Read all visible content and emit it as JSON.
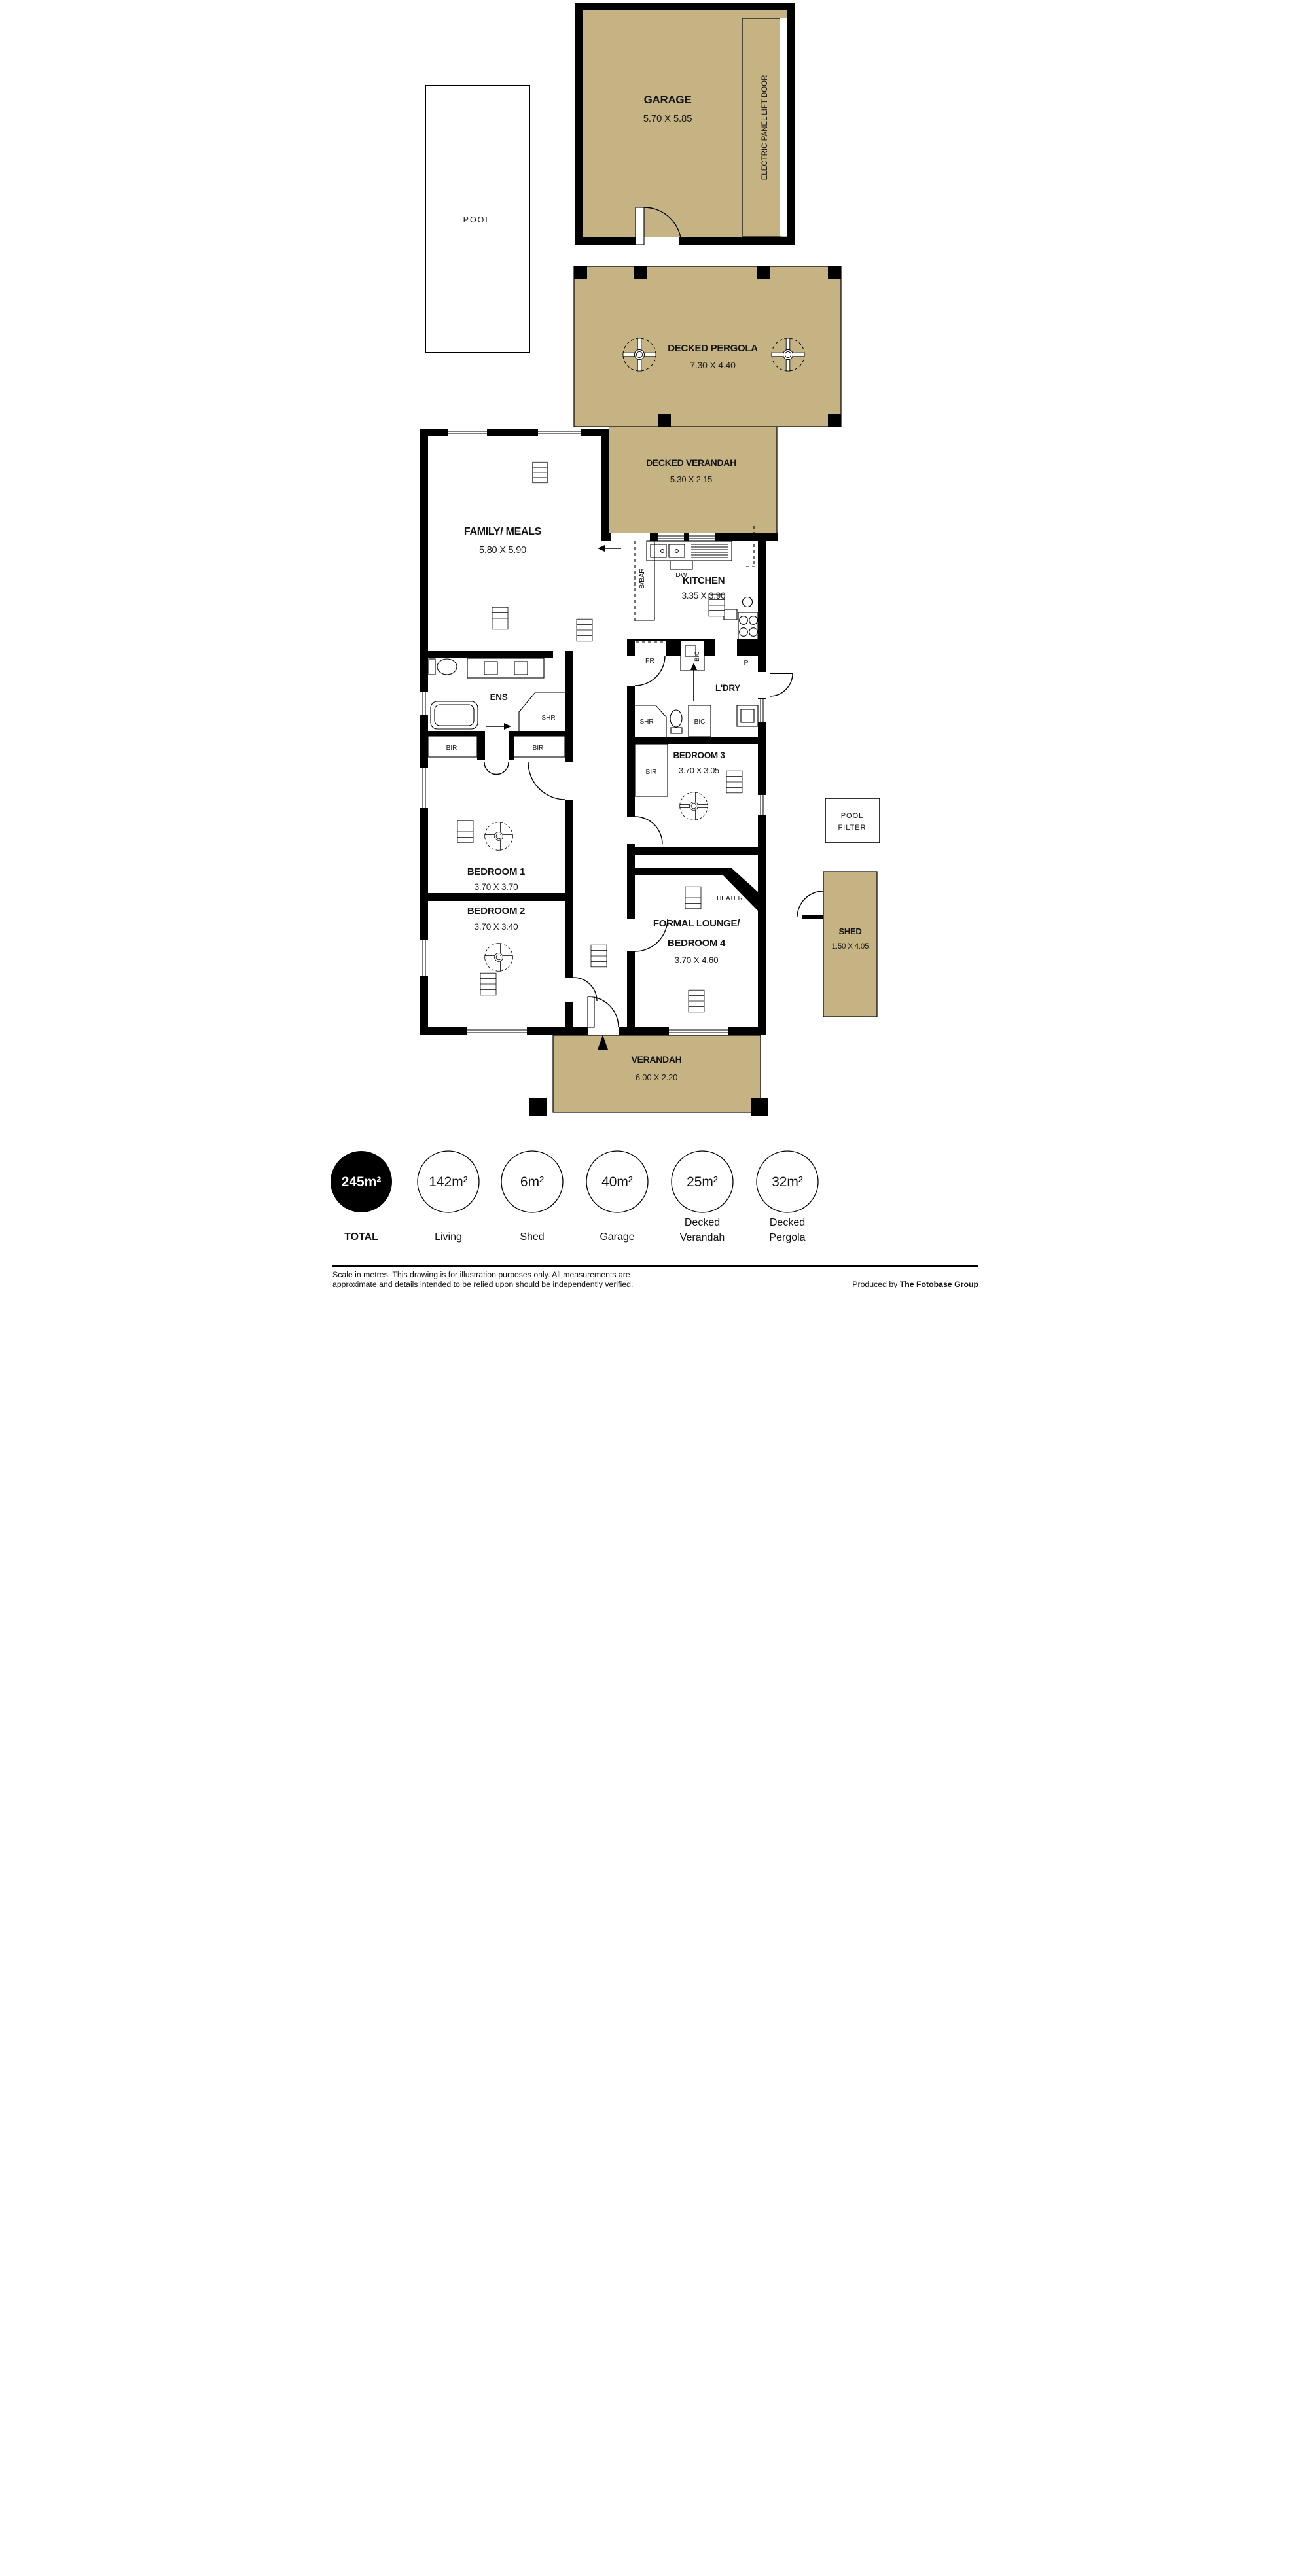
{
  "colors": {
    "deck": "#c6b383",
    "wall": "#000000",
    "paper": "#ffffff"
  },
  "garage": {
    "name": "GARAGE",
    "dims": "5.70 X 5.85",
    "door": "ELECTRIC PANEL LIFT DOOR"
  },
  "pool": {
    "name": "POOL"
  },
  "pergola": {
    "name": "DECKED PERGOLA",
    "dims": "7.30 X 4.40"
  },
  "decked_verandah": {
    "name": "DECKED VERANDAH",
    "dims": "5.30 X 2.15"
  },
  "family": {
    "name": "FAMILY/ MEALS",
    "dims": "5.80 X 5.90"
  },
  "kitchen": {
    "name": "KITCHEN",
    "dims": "3.35 X 3.90",
    "dishwasher": "DW",
    "breakfast_bar": "B/BAR",
    "fridge": "FR",
    "pantry": "P",
    "cupboard": "BIC"
  },
  "laundry": {
    "name": "L'DRY",
    "shower": "SHR",
    "cupboard": "BIC"
  },
  "ensuite": {
    "name": "ENS",
    "shower": "SHR",
    "robe_left": "BIR",
    "robe_right": "BIR"
  },
  "bed1": {
    "name": "BEDROOM 1",
    "dims": "3.70 X 3.70"
  },
  "bed2": {
    "name": "BEDROOM 2",
    "dims": "3.70 X 3.40"
  },
  "bed3": {
    "name": "BEDROOM 3",
    "dims": "3.70 X 3.05",
    "robe": "BIR"
  },
  "lounge": {
    "name_line1": "FORMAL LOUNGE/",
    "name_line2": "BEDROOM 4",
    "dims": "3.70 X 4.60",
    "heater": "HEATER"
  },
  "pool_filter": {
    "line1": "POOL",
    "line2": "FILTER"
  },
  "shed": {
    "name": "SHED",
    "dims": "1.50 X 4.05"
  },
  "verandah": {
    "name": "VERANDAH",
    "dims": "6.00 X 2.20"
  },
  "summary": [
    {
      "value": "245m²",
      "lines": [
        "TOTAL"
      ]
    },
    {
      "value": "142m²",
      "lines": [
        "Living"
      ]
    },
    {
      "value": "6m²",
      "lines": [
        "Shed"
      ]
    },
    {
      "value": "40m²",
      "lines": [
        "Garage"
      ]
    },
    {
      "value": "25m²",
      "lines": [
        "Decked",
        "Verandah"
      ]
    },
    {
      "value": "32m²",
      "lines": [
        "Decked",
        "Pergola"
      ]
    }
  ],
  "footer": {
    "line1": "Scale in metres. This drawing is for illustration purposes only. All measurements are",
    "line2": "approximate and details intended to be relied upon should be independently verified.",
    "credit_prefix": "Produced by ",
    "credit_bold": "The Fotobase Group"
  }
}
